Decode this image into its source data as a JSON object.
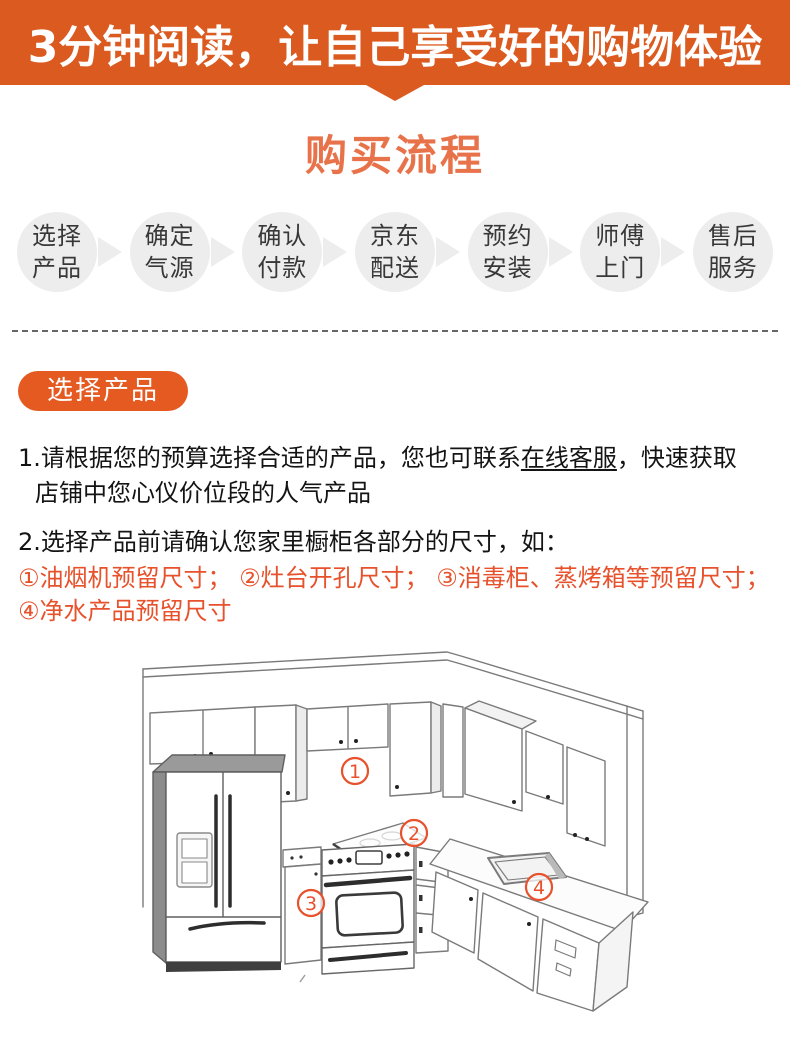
{
  "banner": {
    "text": "3分钟阅读，让自己享受好的购物体验"
  },
  "section": {
    "title": "购买流程"
  },
  "steps": [
    {
      "line1": "选择",
      "line2": "产品"
    },
    {
      "line1": "确定",
      "line2": "气源"
    },
    {
      "line1": "确认",
      "line2": "付款"
    },
    {
      "line1": "京东",
      "line2": "配送"
    },
    {
      "line1": "预约",
      "line2": "安装"
    },
    {
      "line1": "师傅",
      "line2": "上门"
    },
    {
      "line1": "售后",
      "line2": "服务"
    }
  ],
  "badge": {
    "label": "选择产品"
  },
  "paragraph1": {
    "prefix": "1.请根据您的预算选择合适的产品，您也可联系",
    "link": "在线客服",
    "suffix": "，快速获取",
    "line2": "店铺中您心仪价位段的人气产品"
  },
  "paragraph2": {
    "text": "2.选择产品前请确认您家里橱柜各部分的尺寸，如："
  },
  "notes": {
    "line1": "①油烟机预留尺寸； ②灶台开孔尺寸； ③消毒柜、蒸烤箱等预留尺寸；",
    "line2": "④净水产品预留尺寸"
  },
  "diagram": {
    "markers": [
      {
        "num": "1"
      },
      {
        "num": "2"
      },
      {
        "num": "3"
      },
      {
        "num": "4"
      }
    ]
  },
  "colors": {
    "banner_bg": "#DB5A1F",
    "title": "#E8734A",
    "badge_bg": "#E45A21",
    "note_text": "#E7512B",
    "marker": "#E8512B",
    "bubble_bg": "#EDEDED",
    "divider": "#666666"
  }
}
